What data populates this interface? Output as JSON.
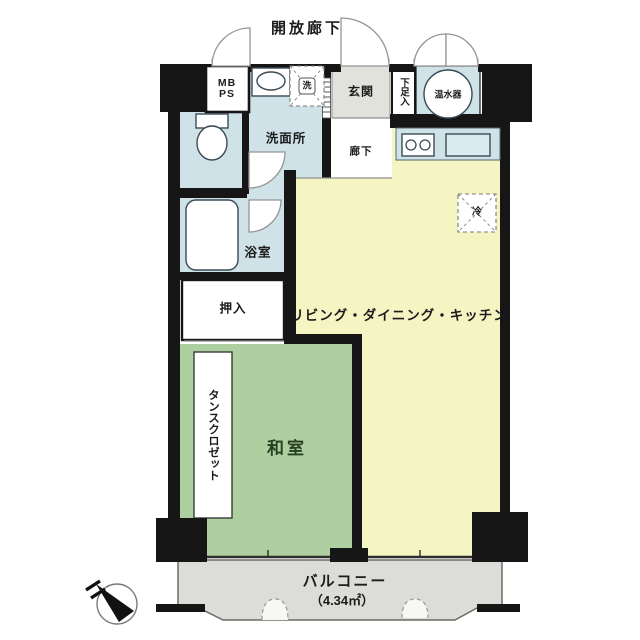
{
  "floorplan": {
    "corridor_label": "開放廊下",
    "rooms": {
      "mb": "MB",
      "ps": "PS",
      "entrance": "玄関",
      "shoe_cabinet": "下足入",
      "water_heater": "温水器",
      "washroom": "洗面所",
      "hallway": "廊下",
      "bathroom": "浴室",
      "closet": "押入",
      "living_dining_kitchen": "リビング・ダイニング・キッチン",
      "japanese_room": "和室",
      "tansu_closet": "タンスクロゼット",
      "balcony": "バルコニー",
      "balcony_area": "（4.34㎡）"
    },
    "marks": {
      "washer": "洗",
      "refrigerator": "冷"
    },
    "balcony_size_sqm": 4.34,
    "colors": {
      "wall": "#161616",
      "wet_room": "#cfe2e8",
      "ldk": "#f5f4c3",
      "japanese_room": "#aecfa0",
      "entrance": "#e2e2dc",
      "balcony": "#dcdcd8",
      "fixture_stroke": "#3a4a55"
    }
  }
}
